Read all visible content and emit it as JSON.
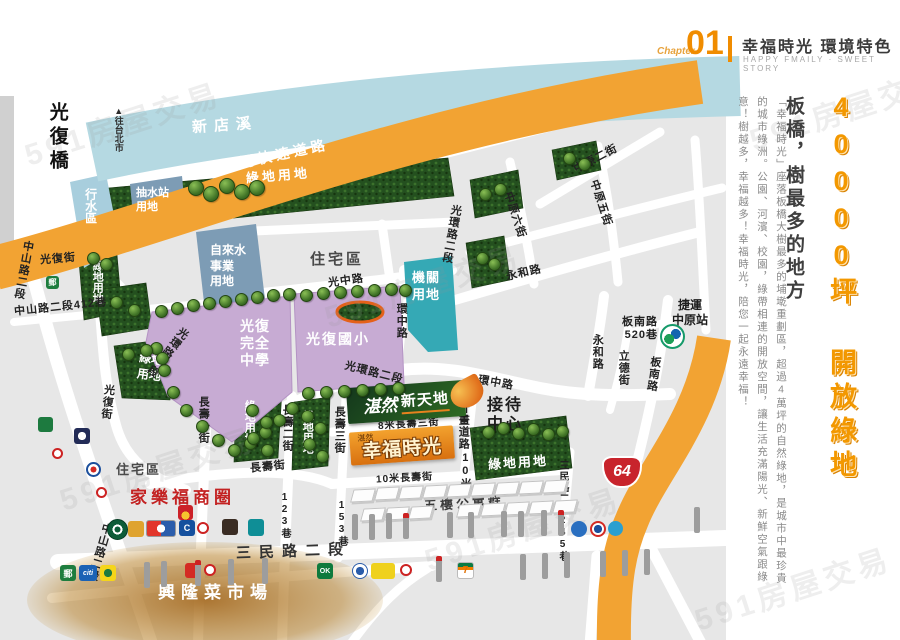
{
  "watermark": "591房屋交易",
  "header": {
    "chapter": "Chapter",
    "number": "01",
    "title": "幸福時光 環境特色",
    "subtitle": "HAPPY FMAILY · SWEET STORY"
  },
  "sidebar": {
    "headline": "40000坪 開放綠地",
    "subhead": "板橋，樹最多的地方",
    "body": "「幸福時光」座落板橋大樹最多的埔墘重劃區，超過4萬坪的自然綠地，是城市中最珍貴的城市綠洲。公園、河濱、校園，綠帶相連的開放空間，讓生活充滿陽光、新鮮空氣跟綠意！樹越多，幸福越多！幸福時光，陪您一起永遠幸福！"
  },
  "map": {
    "labels": {
      "bridge": "光復橋",
      "to_taipei": "▲往台北市",
      "river": "新店溪",
      "expressway": "新北環河快速道路",
      "green_land": "綠地用地",
      "green_land_v": "綠地\n用地",
      "flood_zone": "行水區",
      "pump_station": "抽水站\n用地",
      "water_utility": "自來水\n事業\n用地",
      "residential": "住宅區",
      "agency_land": "機關\n用地",
      "senior_high": "光復\n完全\n中學",
      "elementary": "光復國小",
      "reception": "接待\n中心",
      "apartments": "五樓公寓群",
      "carrefour_area": "家樂福商圈",
      "market": "興隆菜市場",
      "mrt_station": "捷運\n中原站",
      "hw64": "64",
      "plan_road": "計畫道路",
      "plan_road_w": "10米"
    },
    "roads": {
      "zhongshan2": "中山路二段",
      "zhongshan412": "中山路二段412巷",
      "guangfu_st": "光復街",
      "ring1": "光環路一段",
      "ring2": "光環路二段",
      "guangzhong": "光中路",
      "huanzhong": "環中路",
      "yonghe": "永和路",
      "zhongyuan2": "中原二街",
      "zhongyuan5": "中原五街",
      "zhongyuan6": "中原六街",
      "lide": "立德街",
      "bannan": "板南路",
      "bannan520": "板南路\n520巷",
      "changshou1": "長壽一街",
      "changshou2": "長壽二街",
      "changshou3": "長壽三街",
      "changshou": "長壽街",
      "changshou3_8m": "8米長壽三街",
      "changshou_10m": "10米長壽街",
      "lane153": "153巷",
      "lane123": "123巷",
      "sanmin2": "三民路二段",
      "sanmin245": "三民路二段245巷"
    },
    "brand": {
      "script": "湛然",
      "rest": "新天地"
    },
    "site": {
      "prefix": "湛然",
      "name": "幸福時光"
    },
    "icons": {
      "post": "郵",
      "citi": "citi",
      "ok": "OK",
      "seven": "7",
      "bank_c": "C"
    }
  }
}
